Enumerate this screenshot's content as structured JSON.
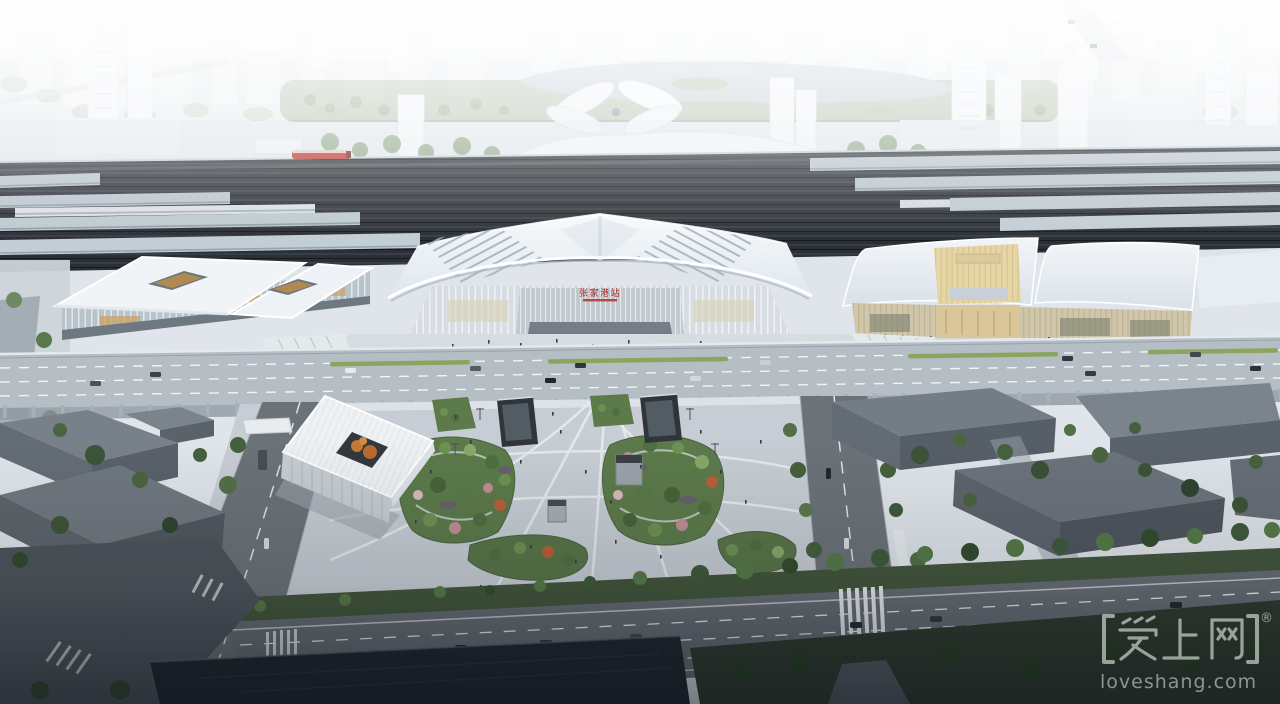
{
  "station": {
    "sign_text": "张家港站",
    "sign_color": "#b3271d"
  },
  "watermark": {
    "brand": "爱上网",
    "brackets": "【】",
    "registered_mark": "®",
    "domain": "loveshang.com",
    "color": "#ffffff"
  },
  "palette": {
    "sky": "#f2f5f7",
    "haze": "#ffffff",
    "track_bed": "#2b3036",
    "platform_canopy": "#b9c4cd",
    "station_roof": "#f4f7f9",
    "gold_roof": "#e7d5a4",
    "plaza_paving": "#c7cdd4",
    "foliage_green": "#5c7a4a",
    "autumn_orange": "#c47a35",
    "flower_pink": "#c08e94",
    "road_grey": "#6b7278",
    "highway_grey": "#666d74",
    "dark_building": "#68717a",
    "water_dark": "#20262e",
    "train_red": "#b8332a"
  }
}
